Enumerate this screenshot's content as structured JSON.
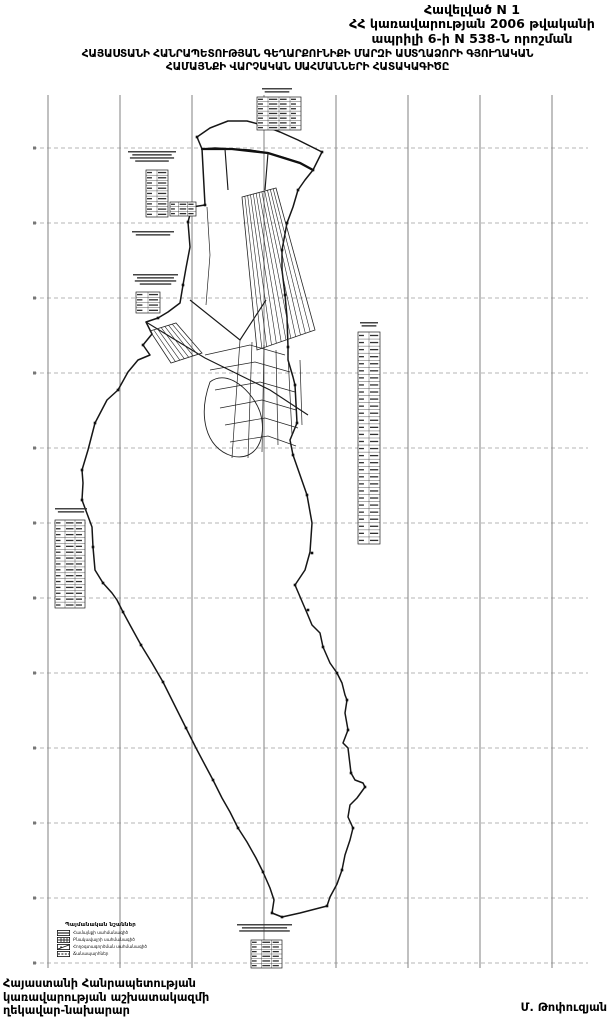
{
  "annex": {
    "line1": "Հավելված N 1",
    "line2": "ՀՀ կառավարության 2006 թվականի",
    "line3": "ապրիլի 6-ի N 538-Ն որոշման"
  },
  "title": {
    "line1": "ՀԱՅԱՍՏԱՆԻ ՀԱՆՐԱՊԵՏՈՒԹՅԱՆ ԳԵՂԱՐՔՈՒՆԻՔԻ ՄԱՐԶԻ ԱՍՏՂԱՁՈՐԻ ԳՅՈՒՂԱԿԱՆ",
    "line2": "ՀԱՄԱՅՆՔԻ ՎԱՐՉԱԿԱՆ ՍԱՀՄԱՆՆԵՐԻ ՀԱՏԱԿԱԳԻԾԸ"
  },
  "legend": {
    "title": "Պայմանական նշաններ",
    "items": [
      {
        "symbol": "community-boundary-symbol",
        "label": "Համայնքի սահմանագիծ"
      },
      {
        "symbol": "settlement-boundary-symbol",
        "label": "Բնակավայրի սահմանագիծ"
      },
      {
        "symbol": "landuse-boundary-symbol",
        "label": "Հողօգտագործման սահմանագիծ"
      },
      {
        "symbol": "road-symbol",
        "label": "Ճանապարհներ"
      }
    ]
  },
  "footer": {
    "line1": "Հայաստանի Հանրապետության",
    "line2": "կառավարության աշխատակազմի",
    "line3": "ղեկավար-նախարար",
    "signature": "Մ. Թոփուզյան"
  },
  "map": {
    "colors": {
      "boundary": "#161616",
      "parcel": "#242424",
      "grid_v": "#4a4a4a",
      "grid_h": "#8a8a8a",
      "micro_text": "#303030"
    }
  }
}
